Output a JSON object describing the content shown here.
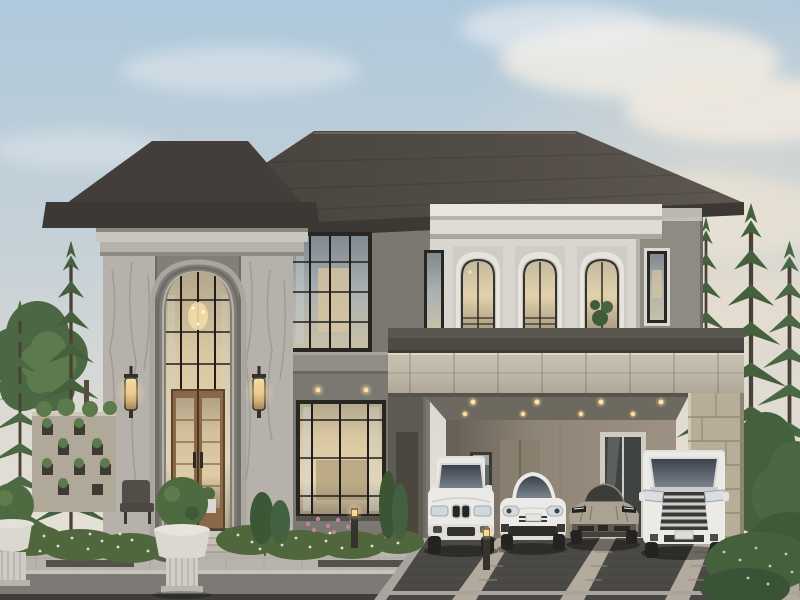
{
  "meta": {
    "title": "Luxury two-storey house exterior rendering at dusk",
    "media_type": "architectural rendering, no visible text"
  },
  "palette": {
    "sky_top": "#aec8dc",
    "sky_horizon": "#eae3d8",
    "roof": "#4f4a44",
    "roof_dark": "#433e3a",
    "fascia": "#3c3935",
    "cornice_light": "#c9c6bf",
    "cornice_dark": "#4e4b45",
    "wall_upper": "#8e8b83",
    "wall_center": "#7b7871",
    "ledge": "#908d85",
    "bay_white": "#e8e5de",
    "bay_body": "#d9d6cf",
    "marble": "#b6b2ab",
    "stone_band": "#c4bcab",
    "stone_pillar": "#b7ae99",
    "carport_wall": "#9c9182",
    "carport_ceiling": "#6d695f",
    "carport_side": "#5e5b53",
    "window_frame": "#272623",
    "door_wood": "#8a6847",
    "steps": "#cdc8bd",
    "planter": "#dbd8d1",
    "topiary": "#4d6a41",
    "hedge": "#50673e",
    "flower_white": "#edefe3",
    "flower_pink": "#c2829d",
    "tree_dark": "#44603c",
    "tree_mid": "#4b6743",
    "tree_light": "#5d7a4c",
    "trunk": "#554b3e",
    "walkway": "#b7b4ad",
    "driveway": "#4a4845",
    "drive_strip": "#b2ab9d",
    "road": "#7d7a76",
    "car_white": "#eceae7",
    "car_champagne": "#aaa394",
    "tire": "#242321",
    "chrome": "#cfcdc9",
    "glass_car": "#424a52",
    "light_warm": "#f3d894"
  },
  "scene": {
    "setting": "luxury two-storey modern classical house at dusk with warm interior lighting",
    "house": {
      "storeys": 2,
      "roof": "dark hip roof",
      "features": [
        "double-height arched entry tower with marble pilasters and wall sconces",
        "three arched white-trimmed windows above the carport",
        "travertine stone band and pillar at the carport",
        "wooden double entry door with glass panels",
        "black-framed gridded windows with warm glow"
      ]
    },
    "vehicles": [
      {
        "label": "white luxury SUV",
        "position": "first bay"
      },
      {
        "label": "white sports sedan",
        "position": "second bay"
      },
      {
        "label": "champagne supercar",
        "position": "third bay"
      },
      {
        "label": "white luxury minivan",
        "position": "fourth bay"
      }
    ],
    "landscape": {
      "left": [
        "Norfolk pines",
        "decorative stone screen wall with planter pockets",
        "outdoor chair",
        "white urn planters with boxwood topiary",
        "white flowering hedge"
      ],
      "right": [
        "Norfolk pines",
        "clipped dark hedge"
      ],
      "foreground": [
        "light stone walkway with dark inlays",
        "dark paver driveway with light stone strips",
        "bollard lights",
        "pink flower patch"
      ]
    },
    "lighting": [
      "recessed carport downlights",
      "lit wall sconces",
      "glowing interiors",
      "soft dusk clouds"
    ]
  }
}
